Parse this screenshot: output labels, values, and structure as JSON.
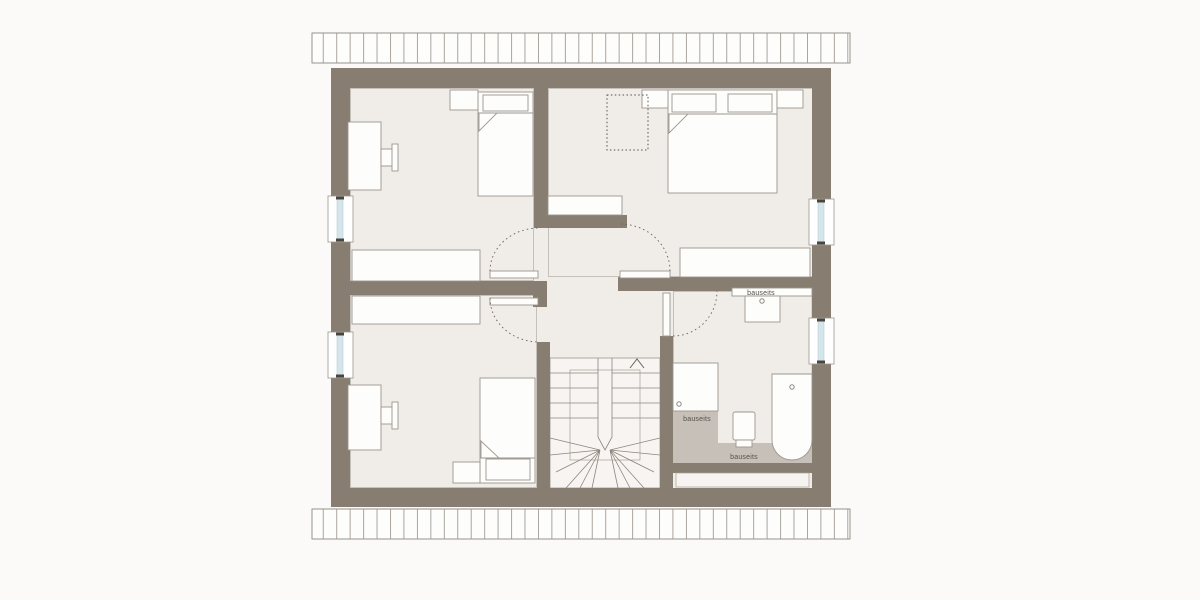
{
  "title": "attic-floor-plan",
  "labels": {
    "washbasin_area": "bauseits",
    "shower_area": "bauseits",
    "toilet_area": "bauseits"
  },
  "icons": {
    "stair_direction_arrow": "chevron-up",
    "faucet_marks": "small-circle"
  },
  "colors": {
    "background": "#fbfaf8",
    "wall": "#877d70",
    "floor": "#f0ece8",
    "stair_floor": "#f7f4f1",
    "bath_floor_gray": "#c6c0b9",
    "furniture_fill": "#fdfdfc",
    "furniture_outline": "#9c968d",
    "window_glass": "#d3e6ec",
    "dashed_line": "#6b645c",
    "hatch_line": "#9b958d",
    "label_text": "#55504a"
  }
}
